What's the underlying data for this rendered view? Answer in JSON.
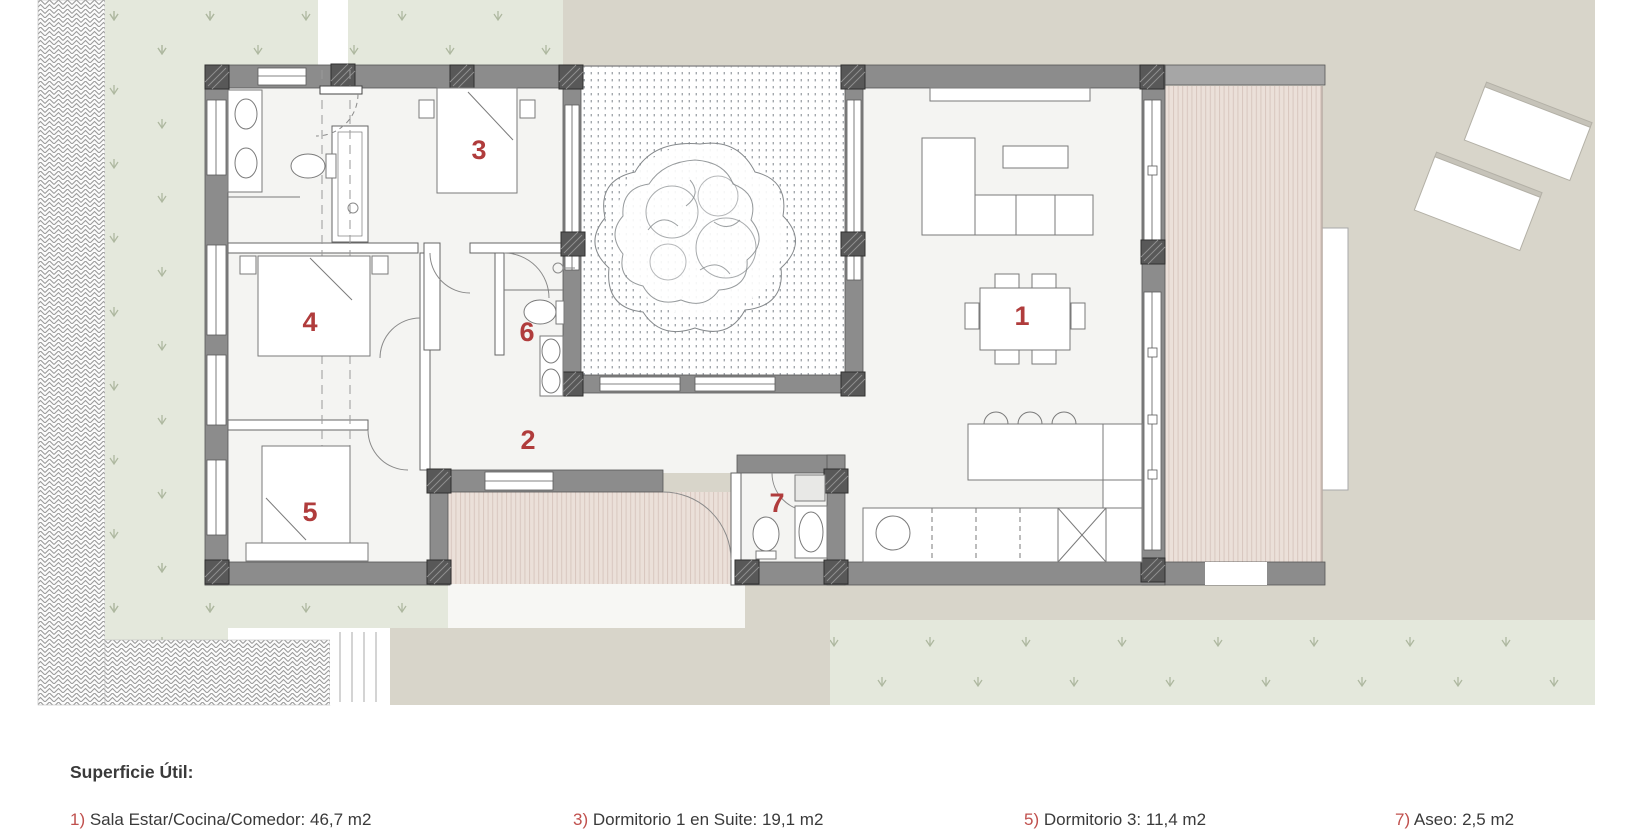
{
  "plan": {
    "title": "Floor plan of single-storey house with courtyard",
    "room_labels": [
      {
        "number": "1",
        "x": 1022,
        "y": 316
      },
      {
        "number": "2",
        "x": 528,
        "y": 440
      },
      {
        "number": "3",
        "x": 479,
        "y": 150
      },
      {
        "number": "4",
        "x": 310,
        "y": 322
      },
      {
        "number": "5",
        "x": 310,
        "y": 512
      },
      {
        "number": "6",
        "x": 527,
        "y": 332
      },
      {
        "number": "7",
        "x": 777,
        "y": 503
      }
    ],
    "label_color": "#b03c3c"
  },
  "legend": {
    "title": "Superficie Útil:",
    "items": [
      {
        "number": "1)",
        "text": " Sala Estar/Cocina/Comedor: 46,7 m2"
      },
      {
        "number": "3)",
        "text": " Dormitorio 1 en Suite: 19,1 m2"
      },
      {
        "number": "5)",
        "text": " Dormitorio 3: 11,4 m2"
      },
      {
        "number": "7)",
        "text": " Aseo: 2,5 m2"
      }
    ],
    "number_color": "#c0504d",
    "text_color": "#3a3a3a"
  },
  "palette": {
    "grass": "#e4e8dc",
    "grass-tuft": "#aeb8a0",
    "paving": "#d8d5ca",
    "deck": "#ebe0d9",
    "deck-stripe": "#d8c7bf",
    "wall": "#8c8c8c",
    "wall-dark": "#555555",
    "column": "#585858",
    "interior": "#f4f4f2",
    "furniture-line": "#7a7a7a",
    "tree-stroke": "#85898c",
    "legend-num": "#c0504d",
    "legend-text": "#3a3a3a"
  }
}
